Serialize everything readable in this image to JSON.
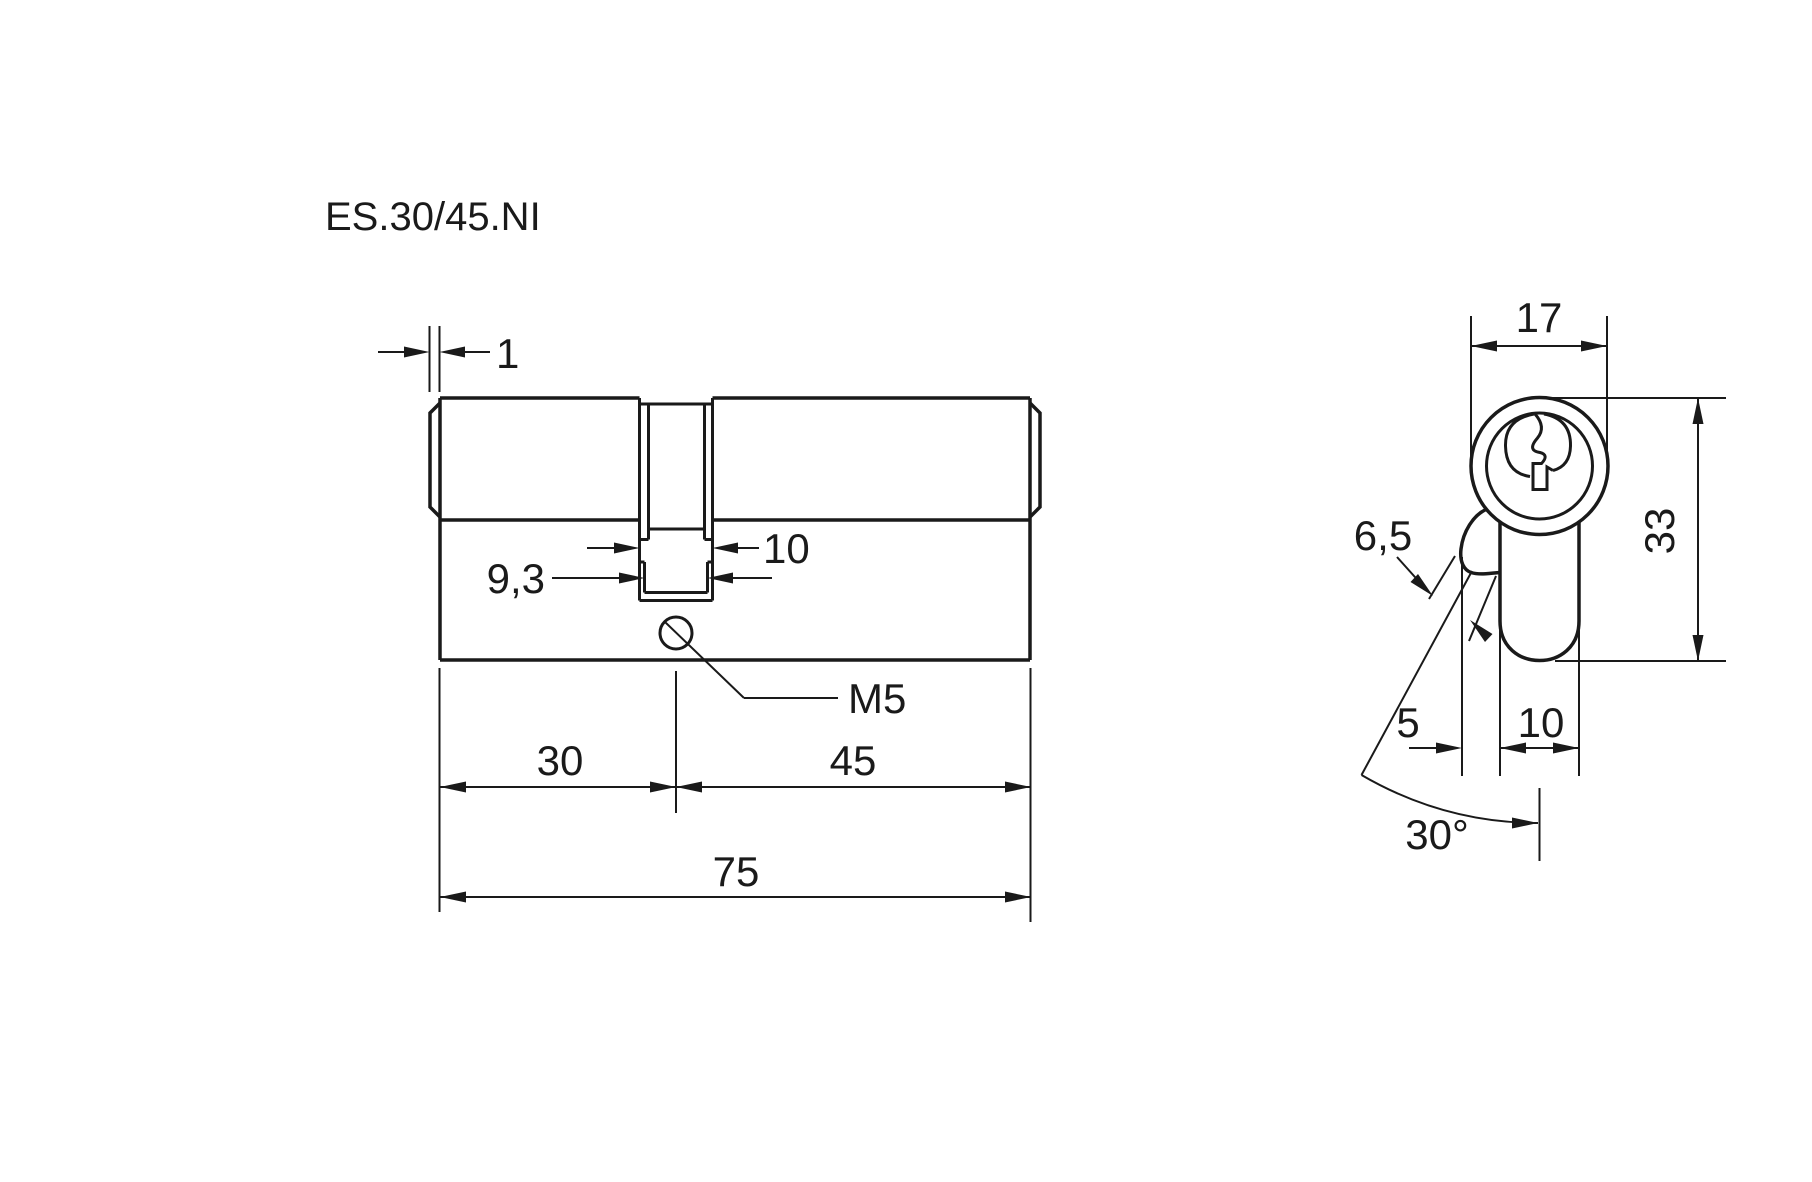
{
  "title": "ES.30/45.NI",
  "colors": {
    "ink": "#1a1a1a",
    "background": "#ffffff"
  },
  "side_view": {
    "description": "lock cylinder side elevation",
    "dims": {
      "cap_protrusion": "1",
      "cam_width_outer": "10",
      "cam_width_inner": "9,3",
      "fixing_screw_thread": "M5",
      "length_a": "30",
      "length_b": "45",
      "length_total": "75"
    }
  },
  "end_view": {
    "description": "lock cylinder end profile with key",
    "dims": {
      "body_width": "17",
      "body_height": "33",
      "cam_throw": "6,5",
      "cam_offset": "5",
      "neck_width": "10",
      "cam_angle": "30°"
    }
  }
}
